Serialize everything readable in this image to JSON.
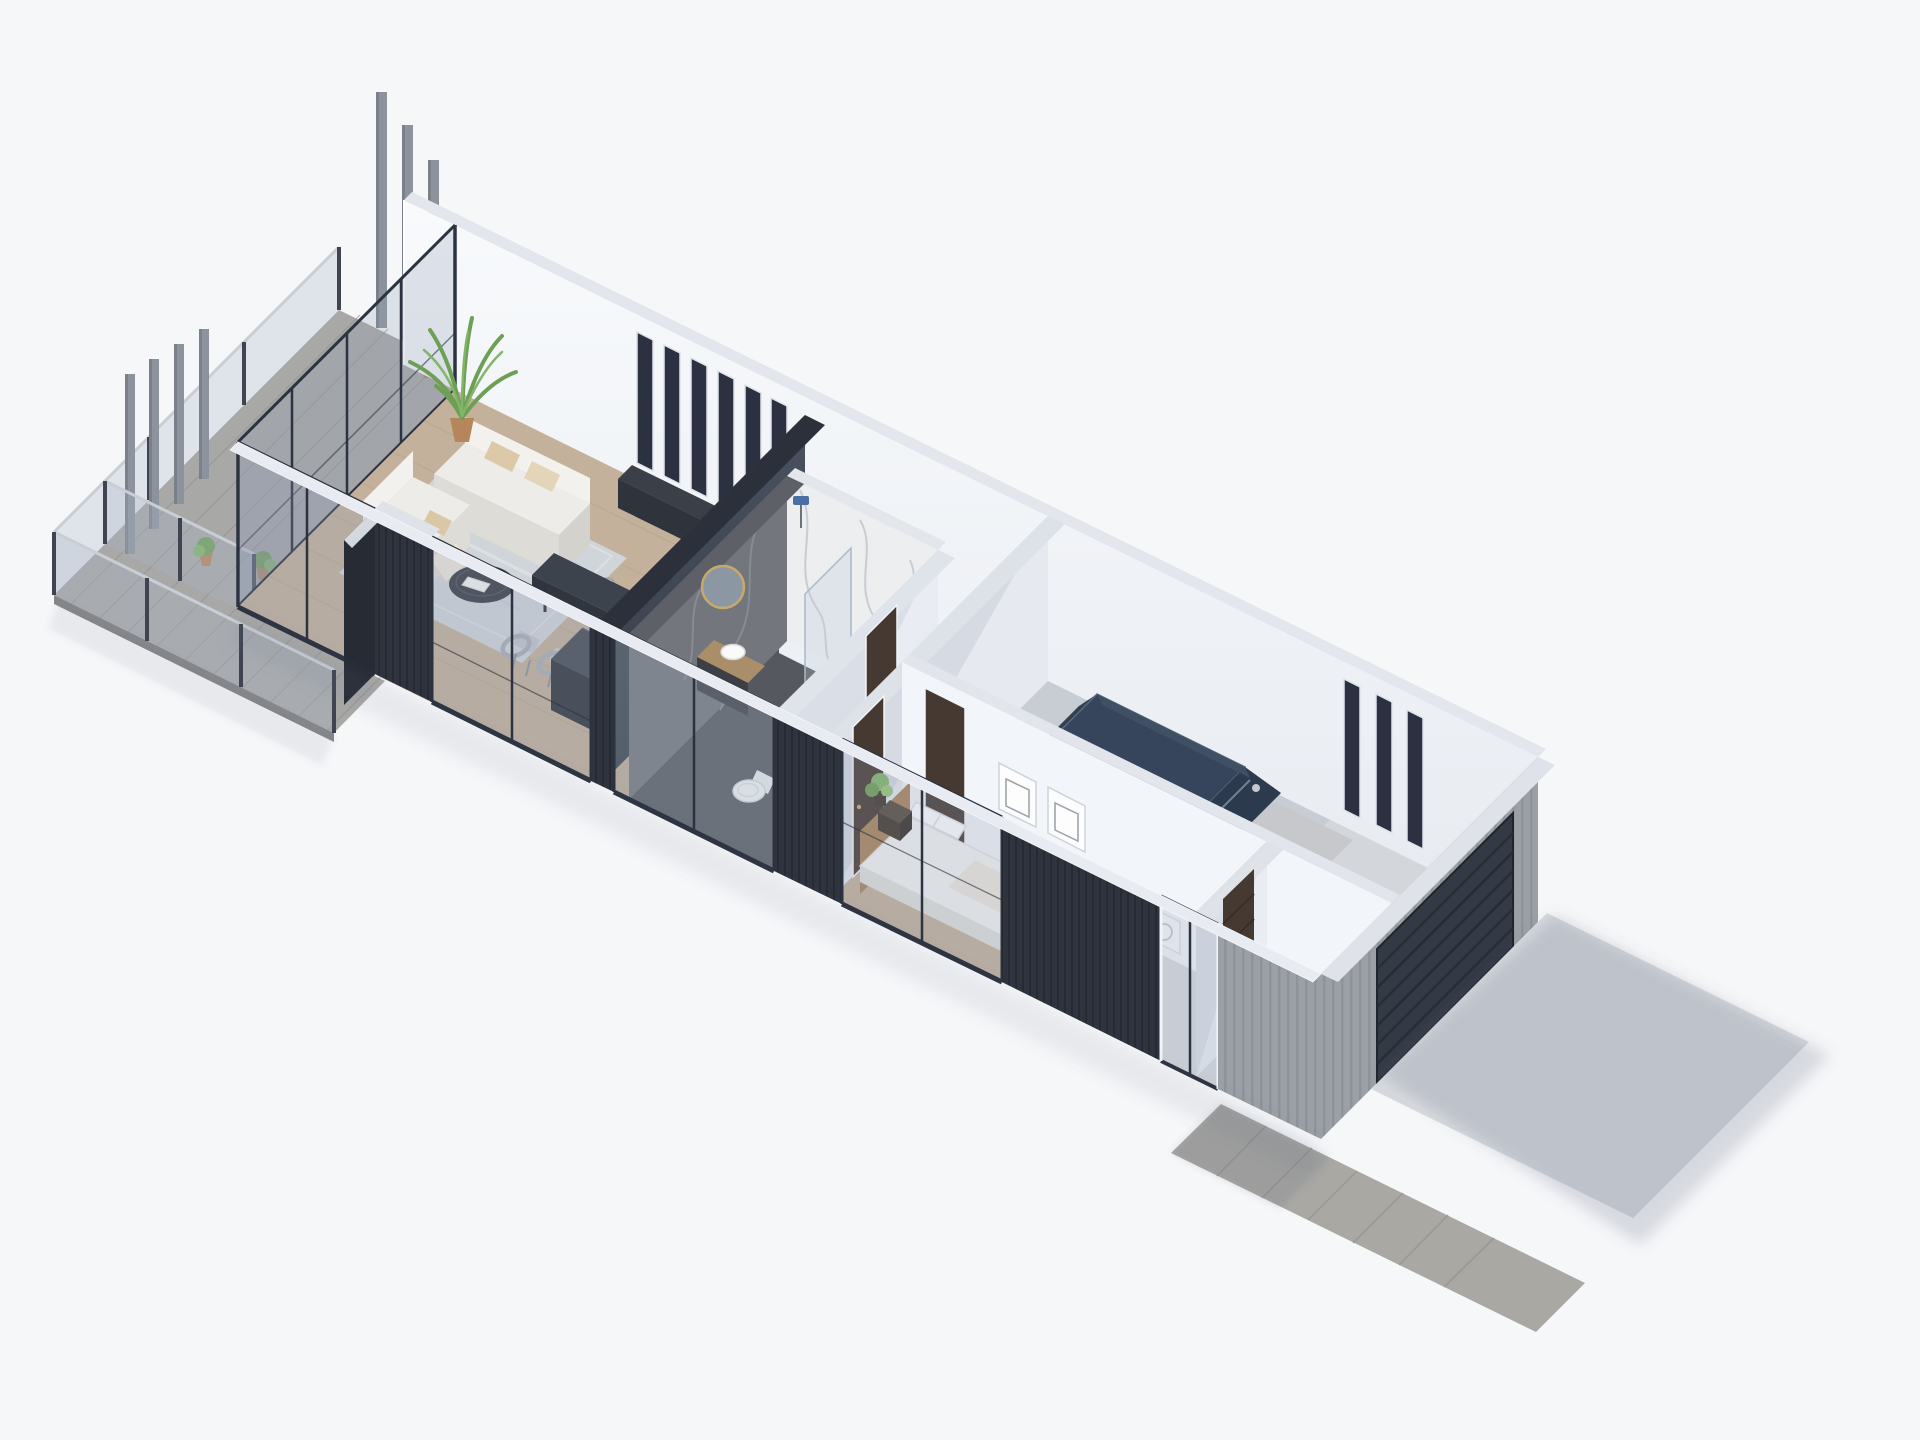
{
  "scene": {
    "type": "isometric-architectural-render",
    "subject": "single-storey modern house cutaway: wooden terrace with glass railing and pergola fins, open living-dining-kitchen, winder staircase, marble bathroom, hallway, bedroom, garage with parked car, concrete driveway and wooden walkway",
    "camera": "high-angle isometric from front-left",
    "floor_count_visible": 1
  },
  "colors": {
    "background": "#f6f7f9",
    "deck": "#a8a8a6",
    "deckPlank": "#8f908e",
    "deckEdge": "#87878a",
    "woodFloor": "#c3b19b",
    "woodGrain": "#b2a089",
    "wallBright": "#f2f5f9",
    "wallLight": "#e9edf3",
    "wallShaded": "#e6eaf0",
    "wallCap": "#e3e6ec",
    "capWood": "#b99e78",
    "claddingDark": "#2e333e",
    "claddingDarkLine": "#252a33",
    "claddingGray": "#9aa0a6",
    "claddingGrayLine": "#8d9399",
    "glassTint": "rgba(145,160,180,0.26)",
    "glassRail": "rgba(168,182,198,0.30)",
    "frameDark": "#2c3340",
    "partitionTop": "#4a5160",
    "partitionBottom": "#363c47",
    "partitionCap": "#2b303a",
    "island": "#454b56",
    "islandFront": "#30353d",
    "islandSide": "#3a404a",
    "tableTop": "#3d434d",
    "tableEdge": "#31363e",
    "consoleTop": "#3a3f48",
    "consoleFront": "#2f343c",
    "sofaTop": "#edece8",
    "sofaFront": "#dedcd7",
    "sofaBack": "#f2f1ed",
    "pillowBeige": "#dcc9a7",
    "rug": "#d0d5da",
    "coffeeTable": "#383d46",
    "marbleLight": "#eceef0",
    "marbleVein": "#b9bfc7",
    "marbleDark": "#73777d",
    "marbleDarkVein": "#8d9299",
    "stairWood": "#dccbad",
    "stairSeam": "#c2b193",
    "doorBrown": "#463931",
    "carTan": "#b5a492",
    "carTanDark": "#a89888",
    "carSilver": "#c6c8cb",
    "carGlass": "#36455b",
    "carWindshield": "#2c3a4d",
    "tire": "#23262b",
    "concrete": "#d3d6db",
    "entryFloor": "#d8dbdf",
    "driveway": "#d7dade",
    "walkway": "#a9a8a3",
    "walkwayLine": "#94938f",
    "garageDoor": "#343a45",
    "garageDoorLine": "#272c35",
    "pot": "#b5855c",
    "plantGreen": "#6f9e56",
    "plantLight": "#82b568",
    "counterWood": "#aa8e69",
    "sinkWhite": "#fafafa",
    "toiletWhite": "#fbfbfb",
    "mirrorGold": "#c9a86a",
    "mirrorGlass": "#8b97a3",
    "showerHead": "#4a6fa5",
    "finGray": "#8d939c",
    "postDark": "#3f4450",
    "railLight": "#c9ced6",
    "bedWhite": "#f4f4f2",
    "headboardWood": "#a9835a",
    "benchWood": "#b08a5e",
    "nightstandTop": "#55493c",
    "nightstandFront": "#3e352b",
    "nightstandSide": "#332c24",
    "blanket": "#efe9dd",
    "chairSeat": "#c3c7cd",
    "chairFrame": "#aab0b8",
    "chairLeg": "#8d939b",
    "applianceWhite": "#f7f8fa",
    "shadow": "rgba(95,105,130,0.18)"
  },
  "elements": {
    "terrace": [
      "weathered-deck",
      "pergola-fins-back",
      "pergola-fins-left",
      "glass-railings",
      "potted-plants",
      "bollard-light"
    ],
    "living_room": [
      "glass-corner-wall",
      "window-slats-6",
      "palm-plant",
      "sofa-long",
      "sofa-short",
      "round-coffee-table",
      "area-rug",
      "media-console"
    ],
    "dining_kitchen": [
      "dark-dining-table",
      "six-chairs",
      "kitchen-island-dark"
    ],
    "stair_hall": [
      "winder-stairs-wood",
      "charcoal-partition-wall",
      "half-wall-wood-cap"
    ],
    "bathroom": [
      "marble-shower-wall",
      "dark-marble-vanity-wall",
      "round-gold-mirror",
      "vessel-sink",
      "wood-counter",
      "glass-shower-screen",
      "shower-head",
      "toilet",
      "dark-tile-floor"
    ],
    "hallway": [
      "brown-door-bathroom",
      "brown-door-bedroom",
      "brown-door-hall"
    ],
    "bedroom": [
      "bed-wood-headboard",
      "pillows",
      "blanket",
      "foot-bench",
      "nightstand-dark",
      "plant",
      "wall-art-niches",
      "sliding-glass-doors"
    ],
    "entry": [
      "brown-slat-door",
      "washing-machine",
      "concrete-pad"
    ],
    "garage": [
      "parked-car-tan-silver",
      "window-slats-3",
      "sectional-garage-door",
      "concrete-floor"
    ],
    "exterior": [
      "dark-slat-cladding",
      "gray-plank-cladding",
      "white-cut-wall-caps",
      "concrete-driveway",
      "wood-walkway",
      "cast-shadows"
    ]
  }
}
